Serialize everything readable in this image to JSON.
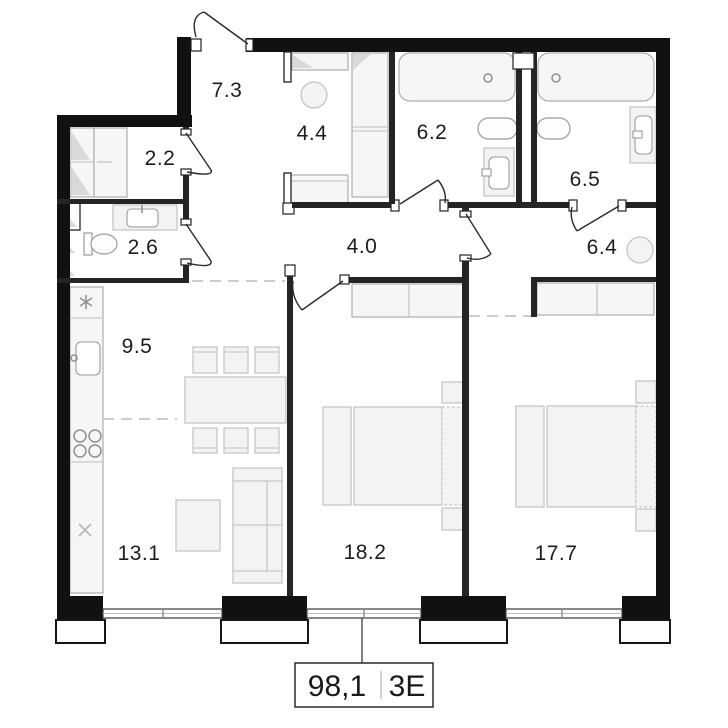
{
  "plan": {
    "type": "apartment-floor-plan",
    "rooms": [
      {
        "name": "entry-hall",
        "area": "7.3"
      },
      {
        "name": "wardrobe",
        "area": "2.2"
      },
      {
        "name": "bathroom-guest",
        "area": "2.6"
      },
      {
        "name": "dressing-room",
        "area": "4.4"
      },
      {
        "name": "bathroom-shared",
        "area": "6.2"
      },
      {
        "name": "bathroom-master",
        "area": "6.5"
      },
      {
        "name": "master-hall",
        "area": "6.4"
      },
      {
        "name": "corridor",
        "area": "4.0"
      },
      {
        "name": "kitchen",
        "area": "9.5"
      },
      {
        "name": "living-room",
        "area": "13.1"
      },
      {
        "name": "bedroom",
        "area": "18.2"
      },
      {
        "name": "bedroom-master",
        "area": "17.7"
      }
    ],
    "summary": {
      "total_area": "98,1",
      "layout_code": "3E"
    },
    "colors": {
      "wall": "#111111",
      "furniture_fill": "#f3f3f3",
      "dashed_zone": "#cccccc"
    }
  }
}
